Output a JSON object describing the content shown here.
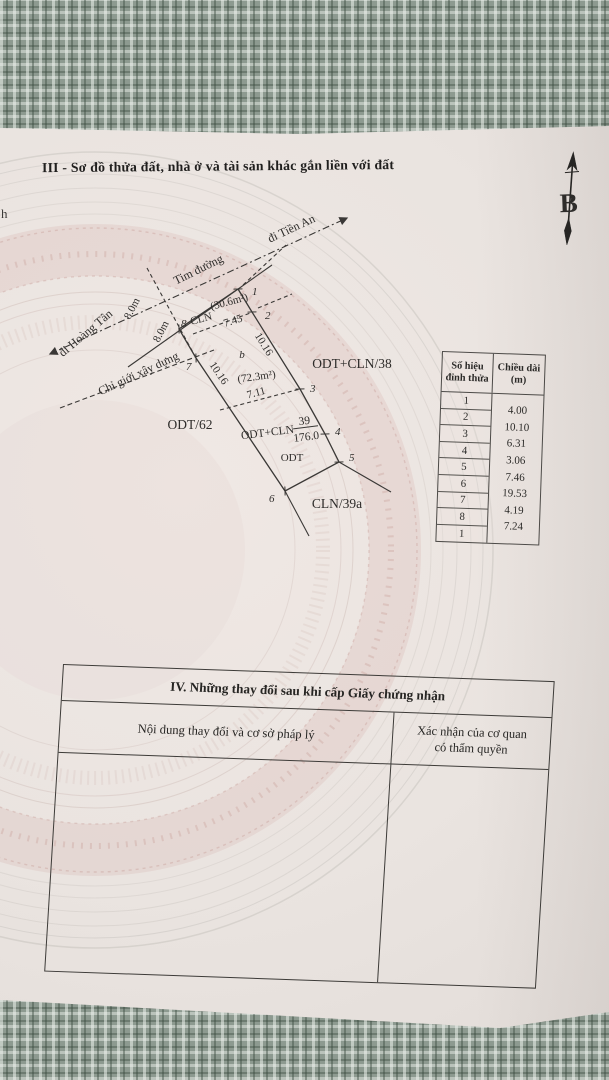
{
  "document": {
    "section3_title": "III - Sơ đồ thửa đất, nhà ở và tài sản khác gắn liền với đất",
    "left_edge_fragment": "h",
    "north_arrow_letter": "B"
  },
  "sketch": {
    "labels": {
      "centerline": "Tim đường",
      "direction_northeast": "đi Tiền An",
      "direction_southwest": "đi Hoàng Tân",
      "building_setback": "Chỉ giới xây dựng",
      "road_offset_1": "8.0m",
      "road_offset_2": "8.0m"
    },
    "parcel": {
      "use_label": "ODT+CLN",
      "parcel_number": "39",
      "area_m2": "176.0",
      "inner_use_top": "CLN",
      "inner_area_top": "(30.6m²)",
      "inner_zone_mid": "b",
      "inner_area_mid": "(72.3m²)",
      "inner_use_bottom": "ODT"
    },
    "dims": {
      "d_745": "7.45",
      "d_711": "7.11",
      "d_1016_left": "10.16",
      "d_1016_right": "10.16"
    },
    "vertices": [
      "1",
      "2",
      "3",
      "4",
      "5",
      "6",
      "7",
      "8"
    ],
    "neighbors": {
      "west": "ODT/62",
      "east": "ODT+CLN/38",
      "south": "CLN/39a"
    }
  },
  "measure_table": {
    "header_col1_line1": "Số hiệu",
    "header_col1_line2": "đỉnh thửa",
    "header_col2_line1": "Chiều dài",
    "header_col2_line2": "(m)",
    "vertex_ids": [
      "1",
      "2",
      "3",
      "4",
      "5",
      "6",
      "7",
      "8",
      "1"
    ],
    "lengths": [
      "4.00",
      "10.10",
      "6.31",
      "3.06",
      "7.46",
      "19.53",
      "4.19",
      "7.24"
    ]
  },
  "section4": {
    "title": "IV. Những thay đổi sau khi cấp Giấy chứng nhận",
    "col1_header": "Nội dung thay đổi và cơ sở pháp lý",
    "col2_header_line1": "Xác nhận của cơ quan",
    "col2_header_line2": "có thẩm quyền"
  }
}
